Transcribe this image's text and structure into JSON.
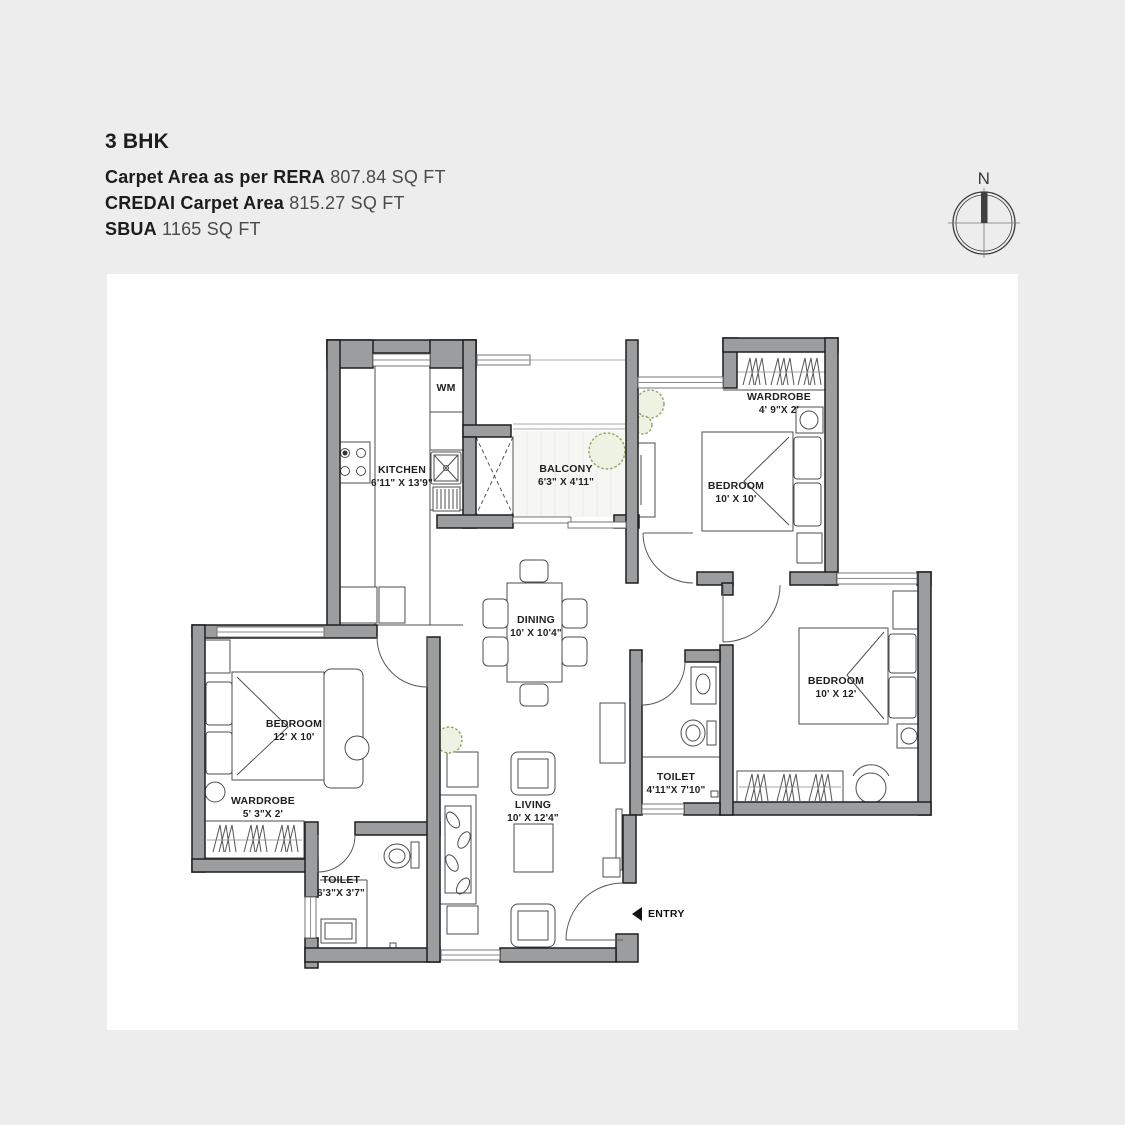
{
  "header": {
    "title": "3 BHK",
    "areas": [
      {
        "label": "Carpet Area as per RERA",
        "value": "807.84 SQ FT"
      },
      {
        "label": "CREDAI Carpet Area",
        "value": "815.27 SQ FT"
      },
      {
        "label": "SBUA",
        "value": "1165 SQ FT"
      }
    ]
  },
  "compass": {
    "north": "N"
  },
  "rooms": {
    "kitchen": {
      "name": "KITCHEN",
      "dims": "6'11\" X 13'9\""
    },
    "wm": {
      "name": "WM"
    },
    "balcony": {
      "name": "BALCONY",
      "dims": "6'3\" X 4'11\""
    },
    "wardrobe_top": {
      "name": "WARDROBE",
      "dims": "4' 9\"X 2'"
    },
    "bedroom_top": {
      "name": "BEDROOM",
      "dims": "10' X 10'"
    },
    "dining": {
      "name": "DINING",
      "dims": "10' X 10'4\""
    },
    "bedroom_right": {
      "name": "BEDROOM",
      "dims": "10' X 12'"
    },
    "toilet_mid": {
      "name": "TOILET",
      "dims": "4'11\"X 7'10\""
    },
    "bedroom_left": {
      "name": "BEDROOM",
      "dims": "12' X 10'"
    },
    "wardrobe_left": {
      "name": "WARDROBE",
      "dims": "5' 3\"X 2'"
    },
    "toilet_left": {
      "name": "TOILET",
      "dims": "6'3\"X 3'7\""
    },
    "living": {
      "name": "LIVING",
      "dims": "10' X 12'4\""
    },
    "entry": {
      "name": "ENTRY"
    }
  },
  "colors": {
    "bg": "#ecedec",
    "panel": "#ffffff",
    "wall": "#9c9d9e",
    "wall_outline": "#1e1e1e",
    "ink": "#1e1e1e",
    "green": "#8aa65d"
  }
}
